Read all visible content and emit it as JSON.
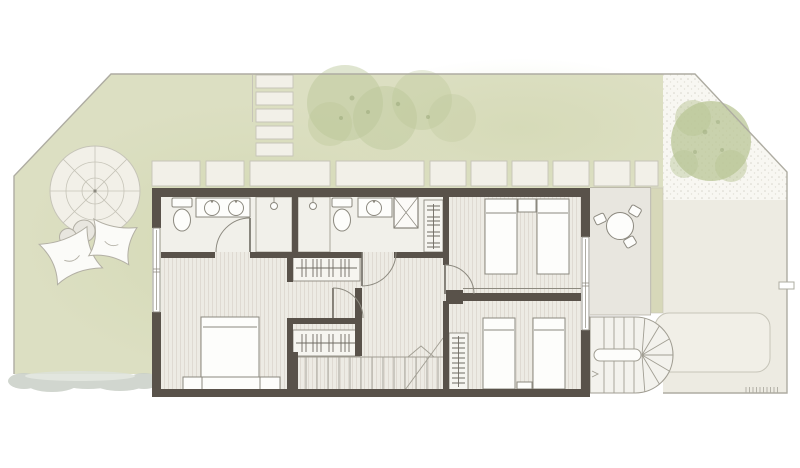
{
  "meta": {
    "title": "Residential floor plan — upper level with garden",
    "view": "top-down architectural plan",
    "has_text_labels": false
  },
  "palette": {
    "bg": "#ffffff",
    "lawn": "#dcdfc2",
    "lawn-shade": "#c9d1a3",
    "boundary": "#aeaca2",
    "paver": "#f2f0e8",
    "paver-edge": "#c6c4b8",
    "gravel": "#f8f7f2",
    "gravel-dot": "#d7d6cc",
    "patio": "#edebe2",
    "balcony": "#e8e6df",
    "olive": "#d7d8b9",
    "daybed": "#f1efe7",
    "wall": "#59524a",
    "floor": "#edebe4",
    "floor-stripe": "#ded9d0",
    "bath-floor": "#f1f0ea",
    "furniture-line": "#8c897f",
    "furniture-fill": "#fdfdfb",
    "wardrobe-fill": "#f6f5f0",
    "tick": "#6f6b62",
    "tree": "#b9c596",
    "tree-dark": "#93a272",
    "bush": "#c9cfc7",
    "white-furn": "#fbfbf8",
    "soft-line": "#b2afa4",
    "stair-line": "#a19e93"
  },
  "garden": {
    "stepping_stones_count": 5,
    "paver_tiles_count": 10,
    "trees_count": 3,
    "parasol": {
      "spokes": 8,
      "rings": 3
    },
    "bean_bags_count": 2,
    "pouf_count": 2,
    "areas": [
      "lawn",
      "gravel-corner",
      "side-patio",
      "planter-strip",
      "hedge-strip"
    ]
  },
  "building": {
    "rooms": [
      {
        "name": "bathroom-1",
        "fixtures": [
          "toilet",
          "double-sink-vanity",
          "shower"
        ]
      },
      {
        "name": "bathroom-2",
        "fixtures": [
          "shower",
          "toilet",
          "sink",
          "service-shaft"
        ]
      },
      {
        "name": "master-bedroom",
        "furniture": [
          "double-bed",
          "foot-bench",
          "window"
        ]
      },
      {
        "name": "walk-in-closet",
        "furniture": [
          "wardrobe",
          "wardrobe"
        ]
      },
      {
        "name": "hall",
        "furniture": [
          "main-staircase"
        ]
      },
      {
        "name": "bedroom-2",
        "furniture": [
          "single-bed",
          "single-bed",
          "nightstand",
          "wardrobe"
        ]
      },
      {
        "name": "bedroom-3",
        "furniture": [
          "single-bed",
          "single-bed",
          "nightstand",
          "shelf-wardrobe",
          "sliding-door"
        ]
      }
    ],
    "beds_total": 5,
    "doors_arc_count": 5,
    "windows_count": 2
  },
  "exterior": {
    "balcony_furniture": [
      "round-table",
      "chair",
      "chair",
      "chair"
    ],
    "spiral_staircase": {
      "flights": 2,
      "winder_treads": 7
    },
    "patio_features": [
      "daybed-outline",
      "plant-ticks",
      "gate-notch"
    ]
  }
}
